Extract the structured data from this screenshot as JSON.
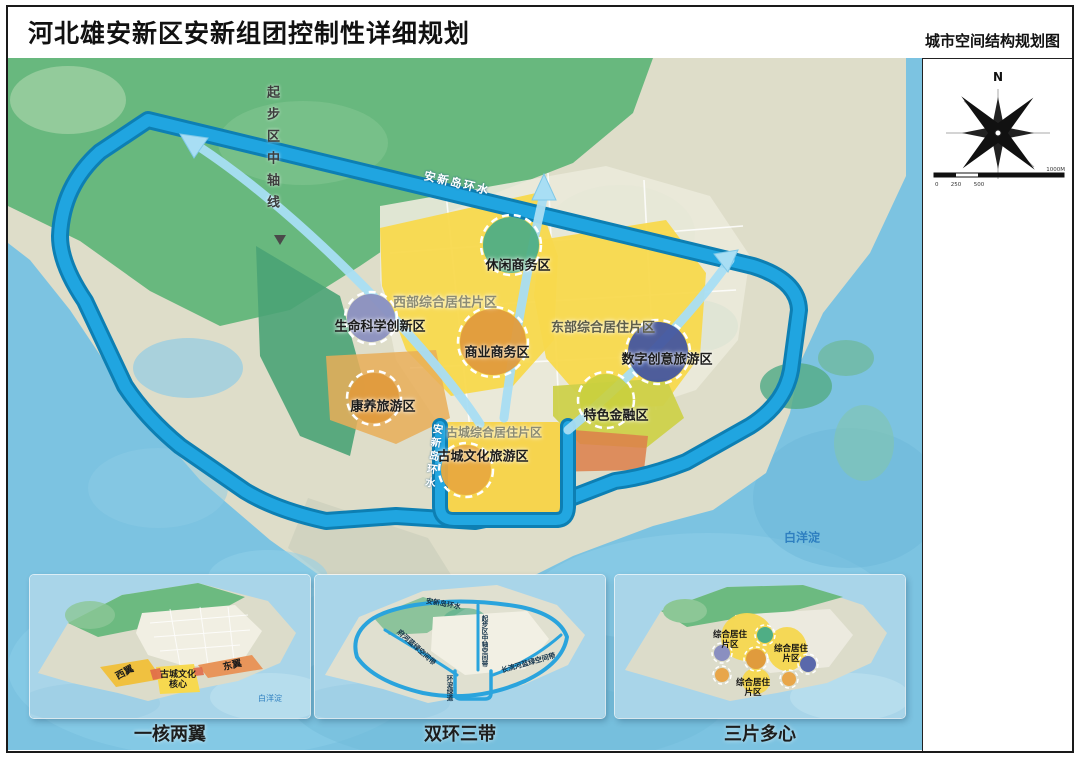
{
  "header": {
    "title": "河北雄安新区安新组团控制性详细规划",
    "map_type_label": "城市空间结构规划图"
  },
  "compass": {
    "north": "N"
  },
  "scale_bar": {
    "t0": "0",
    "t1": "250",
    "t2": "500",
    "t3": "1000M"
  },
  "map": {
    "axis_label": "起步区中轴线",
    "ring_canal_label": "安新岛环水",
    "west_canal_label": "安新岛环水",
    "lake_label": "白洋淀",
    "districts": {
      "leisure_business": "休闲商务区",
      "west_residential": "西部综合居住片区",
      "life_science": "生命科学创新区",
      "commercial_business": "商业商务区",
      "east_residential": "东部综合居住片区",
      "digital_creative": "数字创意旅游区",
      "featured_finance": "特色金融区",
      "wellness_tourism": "康养旅游区",
      "old_town_residential": "古城综合居住片区",
      "old_town_culture": "古城文化旅游区"
    }
  },
  "insets": {
    "one_core_two_wings": {
      "caption": "一核两翼",
      "west_wing": "西翼",
      "core_line1": "古城文化",
      "core_line2": "核心",
      "east_wing": "东翼",
      "lake_label": "白洋淀"
    },
    "double_ring_three_belts": {
      "caption": "双环三带",
      "ring_label": "安新岛环水",
      "axis_belt": "起步区中轴空间带",
      "west_belt": "府河蓝绿空间带",
      "east_belt": "长流河蓝绿空间带",
      "greenway": "环淀绿道"
    },
    "three_areas_multi_centers": {
      "caption": "三片多心",
      "residential_1a": "综合居住",
      "residential_1b": "片区",
      "residential_2a": "综合居住",
      "residential_2b": "片区",
      "residential_3a": "综合居住",
      "residential_3b": "片区"
    }
  },
  "colors": {
    "water": "#7cc3e1",
    "ring_canal": "#20a5e0",
    "ring_canal_edge": "#0d7fb3",
    "forest_green": "#68b87e",
    "residential_yellow": "#f8d94d",
    "commerce_orange": "#e09b3d",
    "leisure_teal": "#4fae85",
    "science_purple": "#8a8fc0",
    "digital_blue": "#44569f",
    "finance_olive": "#ced14b",
    "land_beige": "#deddc9"
  }
}
